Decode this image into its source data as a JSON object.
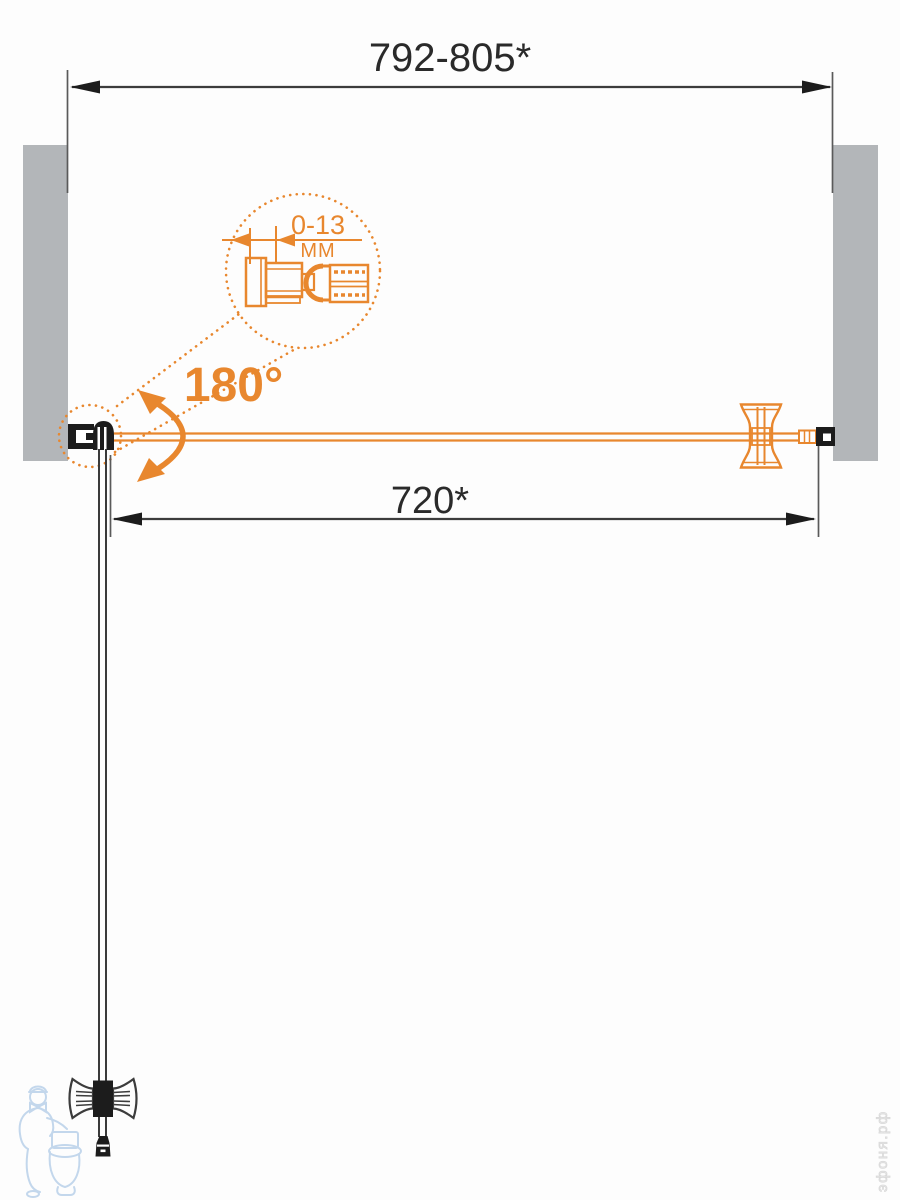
{
  "labels": {
    "opening_width": "792-805*",
    "door_width": "720*",
    "adjustment_range": "0-13",
    "adjustment_unit": "MM",
    "swing_angle": "180°"
  },
  "watermark": {
    "site": "эфоня.рф"
  },
  "colors": {
    "accent": "#e8872e",
    "ink": "#1c1c1c",
    "dim-line": "#3c3c3c",
    "wall": "#b3b6b9",
    "glass": "#3a3a3a",
    "wm-blue": "#c3d7ec",
    "wm-gray": "#d9d9d9",
    "bg": "#fdfdfd"
  }
}
